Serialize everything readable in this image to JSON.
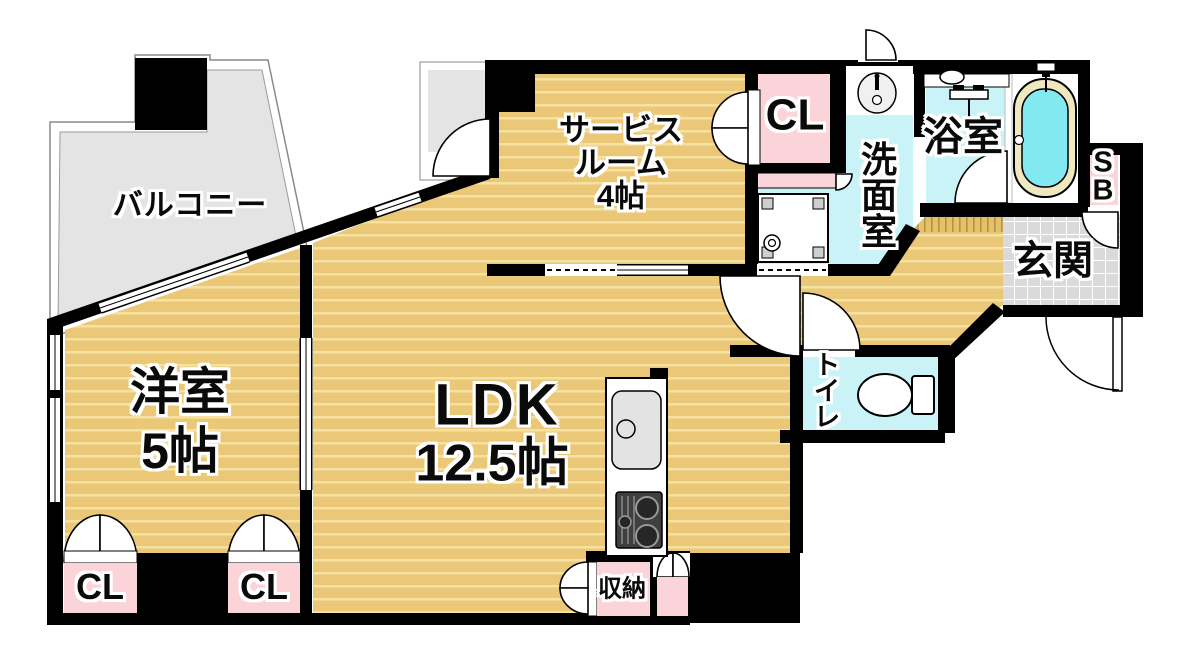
{
  "plan": {
    "type": "floorplan",
    "rooms": {
      "balcony": {
        "label": "バルコニー"
      },
      "service_room": {
        "label": "サービス\nルーム\n4帖",
        "name": "サービスルーム",
        "size": "4帖"
      },
      "closet_service": {
        "label": "CL"
      },
      "washroom": {
        "label": "洗\n面\n室",
        "name": "洗面室"
      },
      "bathroom": {
        "label": "浴室"
      },
      "shoebox": {
        "label": "S\nB",
        "name": "SB"
      },
      "entrance": {
        "label": "玄関"
      },
      "toilet": {
        "label": "ト\nイ\nレ",
        "name": "トイレ"
      },
      "ldk": {
        "name": "LDK",
        "size": "12.5帖"
      },
      "western_room": {
        "label": "洋室\n5帖",
        "name": "洋室",
        "size": "5帖"
      },
      "closet_a": {
        "label": "CL"
      },
      "closet_b": {
        "label": "CL"
      },
      "storage": {
        "label": "収納"
      }
    },
    "colors": {
      "floor_tan": "#ebc878",
      "floor_stripe": "#f5e2a2",
      "closet_pink": "#fad4d8",
      "wet_area_cyan": "#c9f3f7",
      "tub_water": "#82e9f0",
      "tub_rim": "#eee7bf",
      "balcony_gray": "#e4e4e4",
      "entrance_tile": "#dadada",
      "wall": "#000000"
    }
  }
}
